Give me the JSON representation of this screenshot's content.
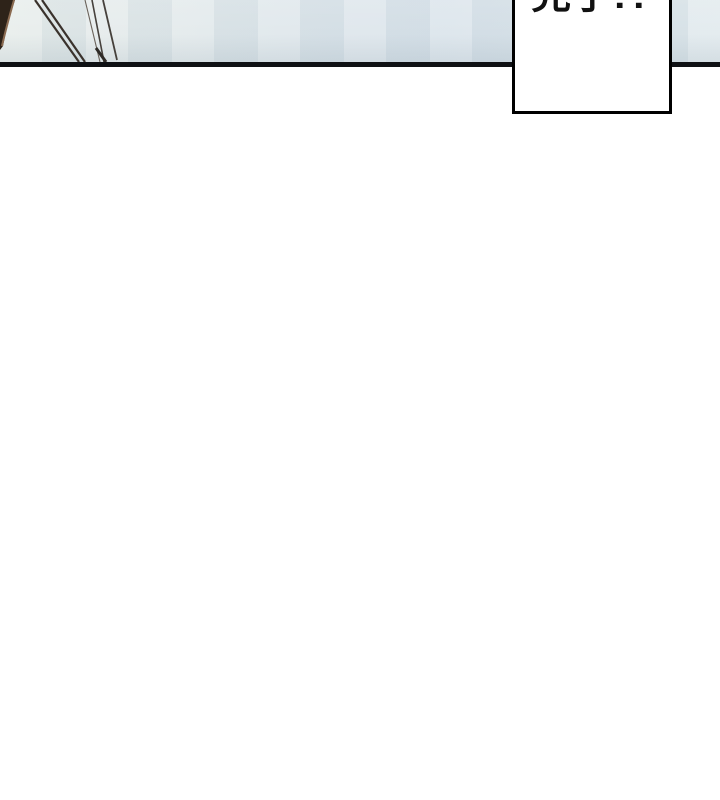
{
  "page": {
    "background_color": "#ffffff",
    "width": 720,
    "height": 800
  },
  "comic": {
    "panel": {
      "background_color": "#dde5ea",
      "border_line_color": "#0f1114",
      "artwork": "hair-strand-lines"
    },
    "speech_bubble": {
      "text": "完了!?",
      "fill_color": "#ffffff",
      "border_color": "#000000"
    }
  }
}
